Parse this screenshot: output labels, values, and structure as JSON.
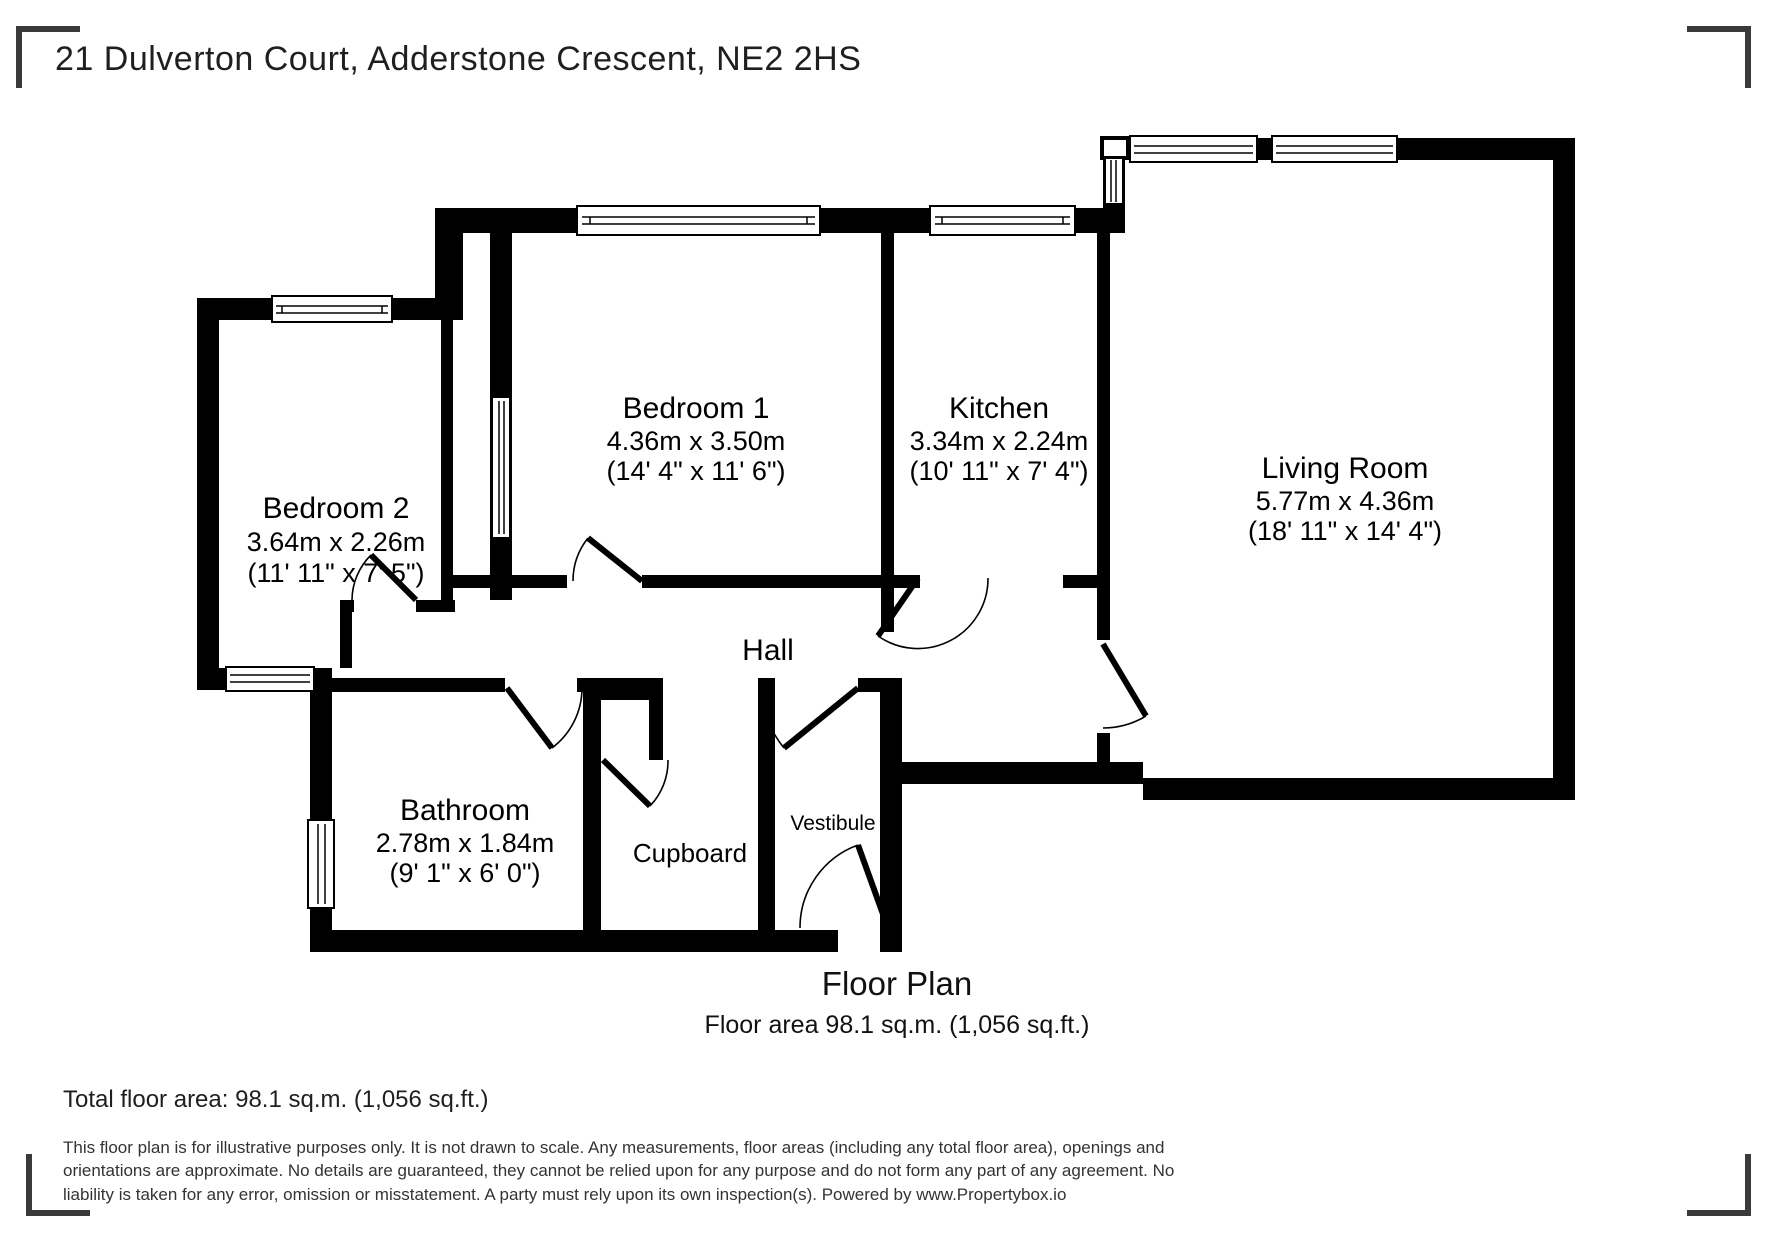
{
  "page": {
    "title": "21 Dulverton Court, Adderstone Crescent, NE2 2HS"
  },
  "floor_plan": {
    "caption_title": "Floor Plan",
    "caption_area": "Floor area 98.1 sq.m. (1,056 sq.ft.)",
    "rooms": [
      {
        "name": "Bedroom 2",
        "metric": "3.64m x 2.26m",
        "imperial": "(11' 11\" x 7' 5\")"
      },
      {
        "name": "Bedroom 1",
        "metric": "4.36m x 3.50m",
        "imperial": "(14' 4\" x 11' 6\")"
      },
      {
        "name": "Kitchen",
        "metric": "3.34m x 2.24m",
        "imperial": "(10' 11\" x 7' 4\")"
      },
      {
        "name": "Living Room",
        "metric": "5.77m x 4.36m",
        "imperial": "(18' 11\" x 14' 4\")"
      },
      {
        "name": "Hall"
      },
      {
        "name": "Bathroom",
        "metric": "2.78m x 1.84m",
        "imperial": "(9' 1\" x 6' 0\")"
      },
      {
        "name": "Cupboard"
      },
      {
        "name": "Vestibule"
      }
    ]
  },
  "summary": {
    "total_area": "Total floor area: 98.1 sq.m. (1,056 sq.ft.)"
  },
  "disclaimer": "This floor plan is for illustrative purposes only. It is not drawn to scale. Any measurements, floor areas (including any total floor area), openings and orientations are approximate. No details are guaranteed, they cannot be relied upon for any purpose and do not form any part of any agreement. No liability is taken for any error, omission or misstatement. A party must rely upon its own inspection(s). Powered by www.Propertybox.io",
  "colors": {
    "wall": "#000000",
    "text": "#000000",
    "bracket": "#3a3a3a",
    "background": "#ffffff"
  }
}
